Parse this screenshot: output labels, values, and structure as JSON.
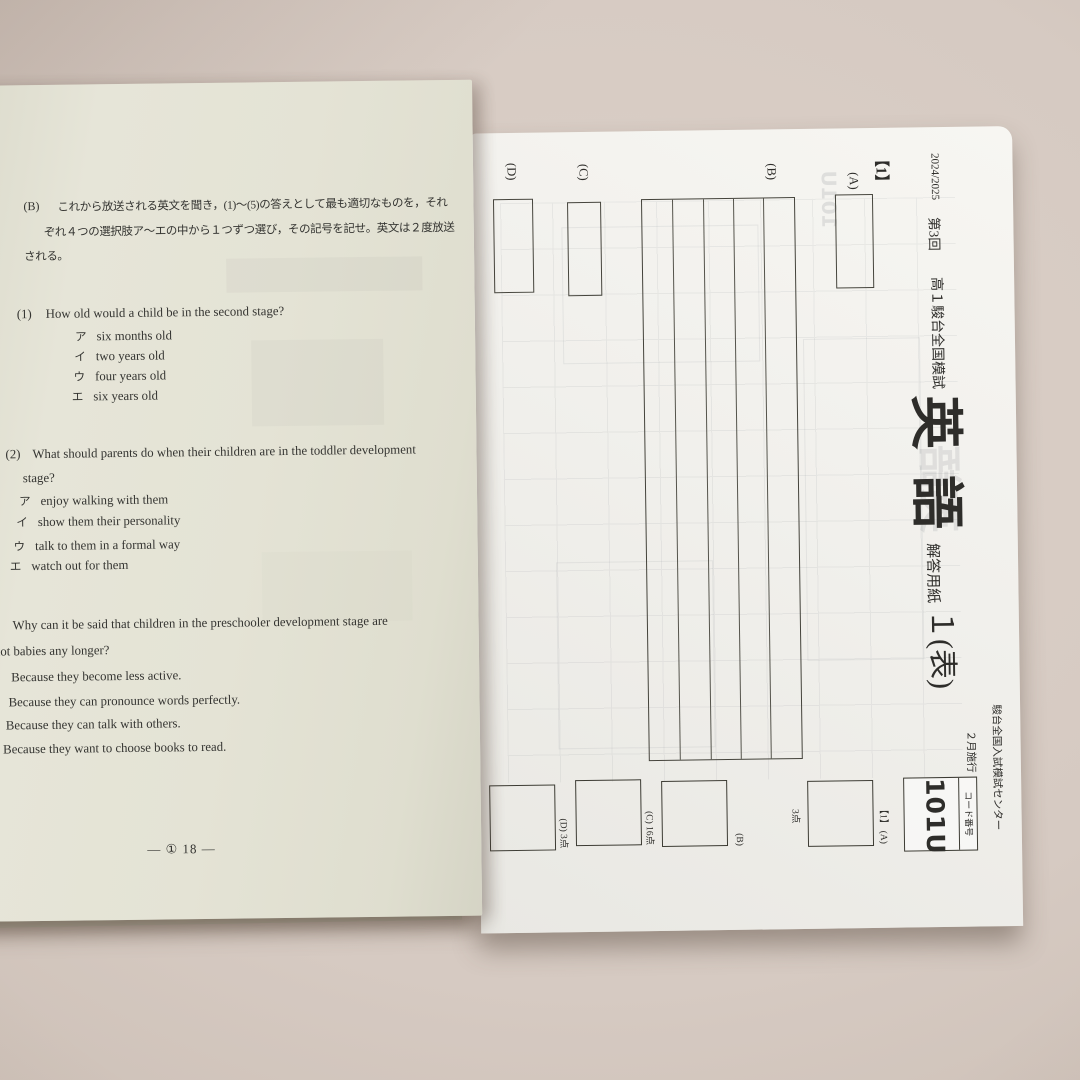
{
  "colors": {
    "background": "#d5c9c1",
    "left_paper": "#e4e3d5",
    "right_paper": "#f1f0ec",
    "ink": "#343431"
  },
  "left_page": {
    "instruction": {
      "label": "(B)",
      "line1": "これから放送される英文を聞き，(1)～(5)の答えとして最も適切なものを，それ",
      "line2": "ぞれ４つの選択肢ア～エの中から１つずつ選び，その記号を記せ。英文は２度放送",
      "line3": "される。"
    },
    "questions": [
      {
        "number": "(1)",
        "text": "How old would a child be in the second stage?",
        "choices": [
          {
            "marker": "ア",
            "text": "six months old"
          },
          {
            "marker": "イ",
            "text": "two years old"
          },
          {
            "marker": "ウ",
            "text": "four years old"
          },
          {
            "marker": "エ",
            "text": "six years old"
          }
        ]
      },
      {
        "number": "(2)",
        "text": "What should parents do when their children are in the toddler development",
        "text_cont": "stage?",
        "choices": [
          {
            "marker": "ア",
            "text": "enjoy walking with them"
          },
          {
            "marker": "イ",
            "text": "show them their personality"
          },
          {
            "marker": "ウ",
            "text": "talk to them in a formal way"
          },
          {
            "marker": "エ",
            "text": "watch out for them"
          }
        ]
      },
      {
        "number": "",
        "text": "Why can it be said that children in the preschooler development stage are",
        "text_cont": "not babies any longer?",
        "choices": [
          {
            "marker": "",
            "text": "Because they become less active."
          },
          {
            "marker": "",
            "text": "Because they can pronounce words perfectly."
          },
          {
            "marker": "",
            "text": "Because they can talk with others."
          },
          {
            "marker": "",
            "text": "Because they want to choose books to read."
          }
        ]
      }
    ],
    "page_number": "— ① 18 —"
  },
  "sheet": {
    "header": {
      "edition": "2024/2025",
      "session": "第3回",
      "exam_name": "高１駿台全国模試",
      "subject": "英語",
      "sheet_label": "解答用紙",
      "sheet_number": "１(表)",
      "organization": "駿台全国入試模試センター",
      "administration": "２月施行",
      "code_label": "コード番号",
      "code_value": "101U"
    },
    "section": {
      "label": "【1】",
      "rows": [
        {
          "label": "(A)"
        },
        {
          "label": "(B)"
        },
        {
          "label": "(C)"
        },
        {
          "label": "(D)"
        }
      ]
    },
    "score_boxes": [
      {
        "label": "【1】 (A)",
        "points": "3点"
      },
      {
        "label": "(B)",
        "points": ""
      },
      {
        "label": "(C) 16点",
        "points": ""
      },
      {
        "label": "(D) 3点",
        "points": ""
      }
    ],
    "bleed": {
      "subject": "英語",
      "code": "101U"
    }
  }
}
